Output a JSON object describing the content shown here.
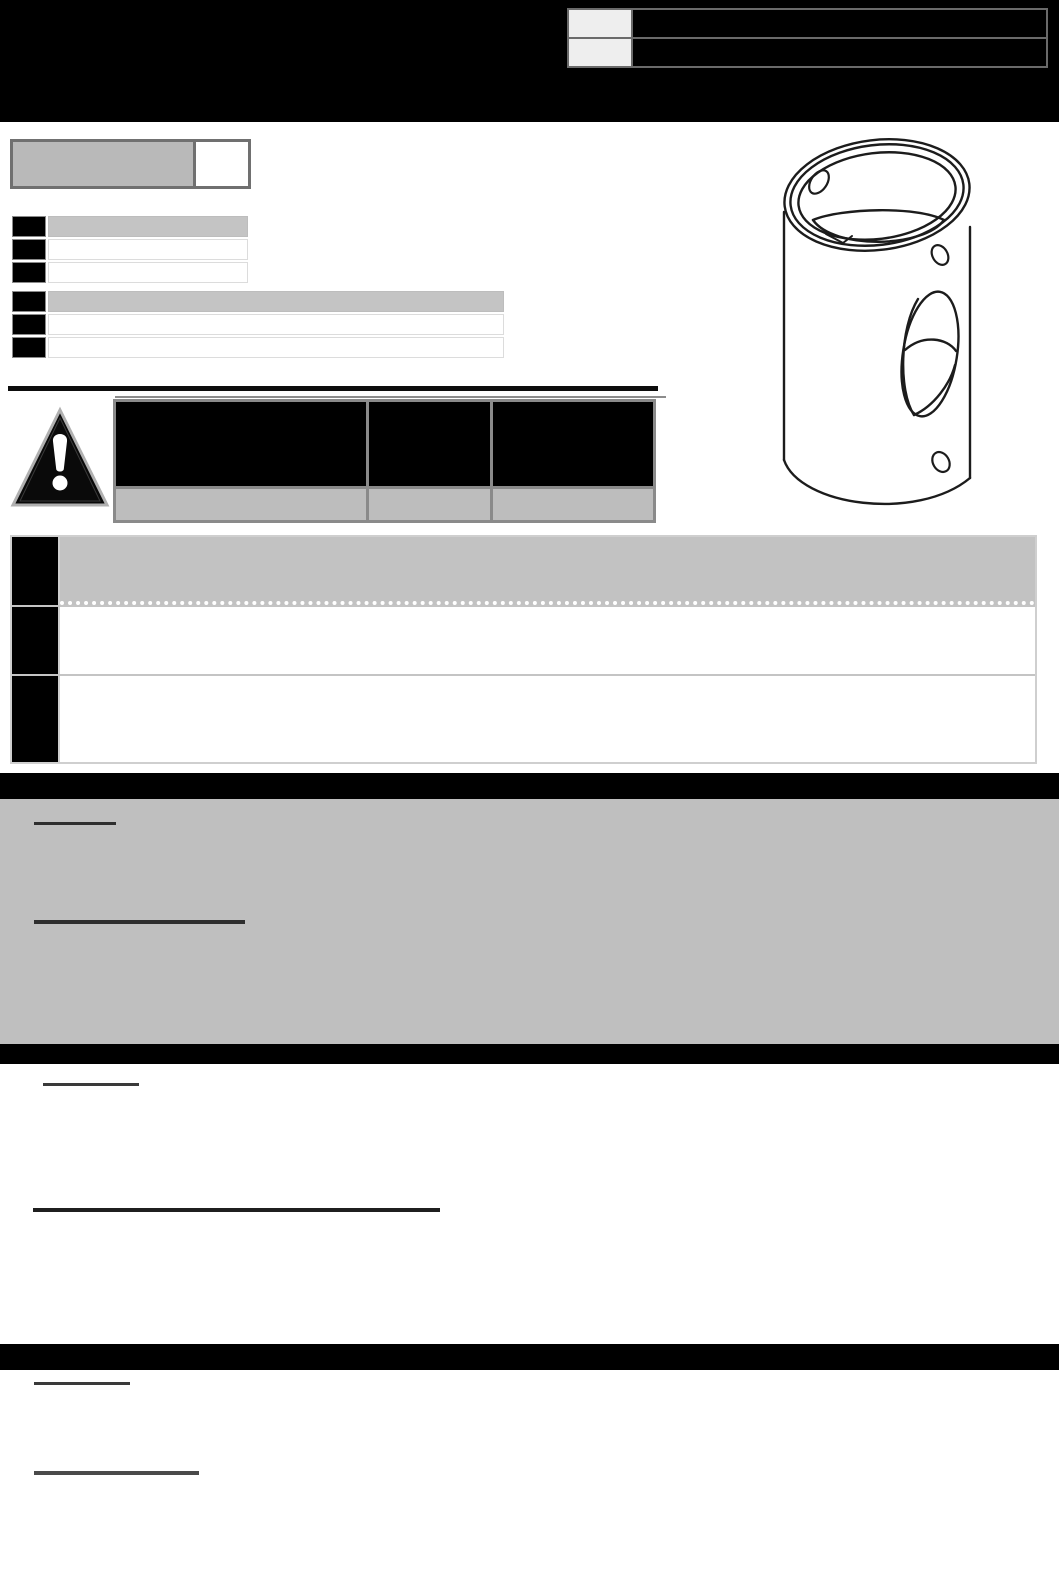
{
  "document": {
    "note": "scanned instruction sheet, all text fields blank/redacted",
    "colors": {
      "banner": "#000000",
      "cell_black": "#000000",
      "cell_gray": "#c2c2c2",
      "cell_light": "#eeeeee",
      "section_gray": "#bfbfbf",
      "border_dark": "#707070",
      "border_table": "#8a8a8a",
      "border_light": "#cfcfcf",
      "underline": "#2e2e2e"
    }
  },
  "header": {
    "info_table": {
      "rows": [
        {
          "label": "",
          "value": ""
        },
        {
          "label": "",
          "value": ""
        }
      ]
    }
  },
  "revision_box": {
    "left": "",
    "right": ""
  },
  "tables": {
    "small": {
      "rows": [
        {
          "num": "",
          "text": ""
        },
        {
          "num": "",
          "text": ""
        },
        {
          "num": "",
          "text": ""
        }
      ]
    },
    "wide": {
      "rows": [
        {
          "num": "",
          "text": ""
        },
        {
          "num": "",
          "text": ""
        },
        {
          "num": "",
          "text": ""
        }
      ]
    },
    "warning": {
      "columns": [
        {
          "header": "",
          "footer": ""
        },
        {
          "header": "",
          "footer": ""
        },
        {
          "header": "",
          "footer": ""
        }
      ]
    },
    "steps": {
      "rows": [
        {
          "num": "",
          "text": ""
        },
        {
          "num": "",
          "text": ""
        },
        {
          "num": "",
          "text": ""
        }
      ]
    }
  },
  "sections": {
    "bar1_title": "",
    "gray_block": {
      "heading1": "",
      "heading2": ""
    },
    "bar2_title": "",
    "white_block1": {
      "heading1": "",
      "heading2": ""
    },
    "bar3_title": "",
    "white_block2": {
      "heading1": "",
      "heading2": ""
    }
  },
  "icons": {
    "warning": "warning-triangle-icon"
  },
  "figure": {
    "name": "cylindrical-part-line-drawing"
  }
}
